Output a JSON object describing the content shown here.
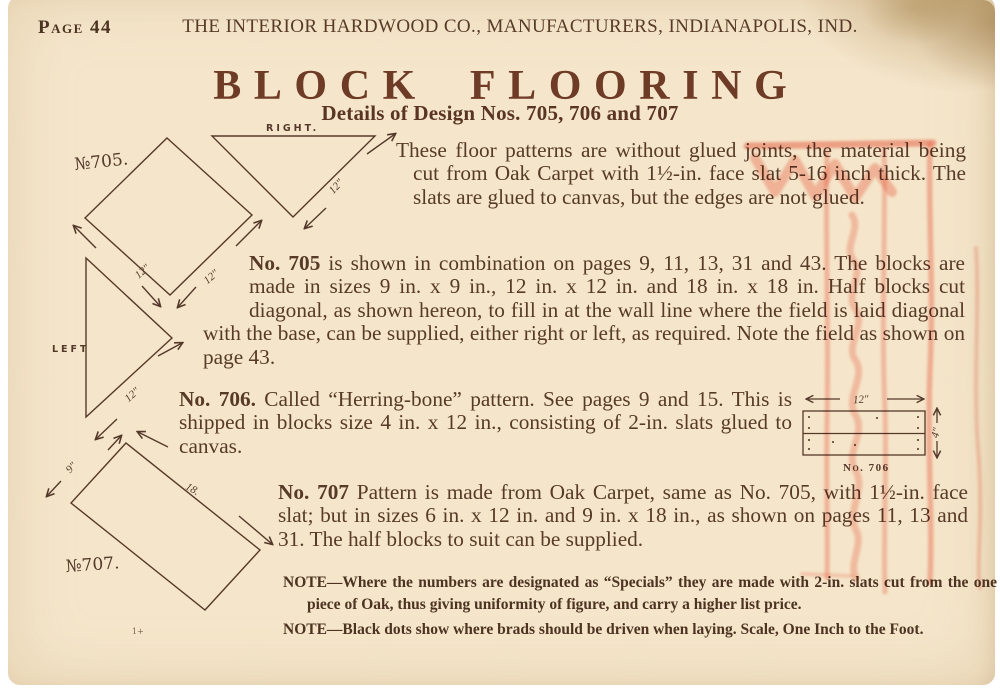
{
  "page": {
    "page_label": "Page 44",
    "masthead": "THE INTERIOR HARDWOOD CO., MANUFACTURERS, INDIANAPOLIS, IND.",
    "title": "BLOCK FLOORING",
    "subtitle": "Details of Design Nos. 705, 706 and 707"
  },
  "paragraphs": {
    "intro": "These floor patterns are without glued joints, the material being cut from Oak Carpet with 1½-in. face slat 5-16 inch thick.  The slats are glued to canvas, but the edges are not glued.",
    "p705_lead": "No. 705",
    "p705_text": " is shown in combination on pages 9, 11, 13, 31 and 43.  The blocks are made in sizes 9 in. x 9 in., 12 in. x 12 in. and 18 in. x 18 in.  Half blocks cut diagonal, as shown hereon, to fill in at the wall line where the field is laid diagonal with the base, can be supplied, either right or left, as required.  Note the field as shown on page 43.",
    "p706_lead": "No. 706.",
    "p706_text": "  Called “Herring-bone” pattern.  See pages 9 and 15.  This is shipped in blocks size 4 in. x 12 in., consisting of 2-in. slats glued to canvas.",
    "p707_lead": "No. 707",
    "p707_text": " Pattern is made from Oak Carpet, same as No. 705, with 1½-in. face slat; but in sizes 6 in. x 12 in. and 9 in. x 18 in., as shown on pages 11, 13 and 31.  The half blocks to suit can be supplied."
  },
  "notes": {
    "note1": "NOTE—Where the numbers are designated as “Specials” they are made with 2-in. slats cut from the one piece of Oak, thus giving uniformity of figure, and carry a higher list price.",
    "note2": "NOTE—Black dots show where brads should be driven when laying.  Scale, One Inch to the Foot."
  },
  "diagrams": {
    "d705": {
      "label": "№705.",
      "dim_left": "12\"",
      "dim_right": "12\""
    },
    "right_half": {
      "label": "RIGHT.",
      "dim": "12\""
    },
    "left_half": {
      "label": "LEFT",
      "dim": "12\""
    },
    "d707": {
      "label": "№707.",
      "dim_short": "9\"",
      "dim_long": "18.",
      "print_mark": "1+"
    },
    "d706": {
      "label": "No. 706",
      "dim_width": "12\"",
      "dim_height": "4\""
    }
  },
  "colors": {
    "paper": "#f5e6cb",
    "ink": "#573a27",
    "title_ink": "#6e3b26",
    "diagram_ink": "#54392a",
    "stamp_red": "#ee6a52"
  }
}
